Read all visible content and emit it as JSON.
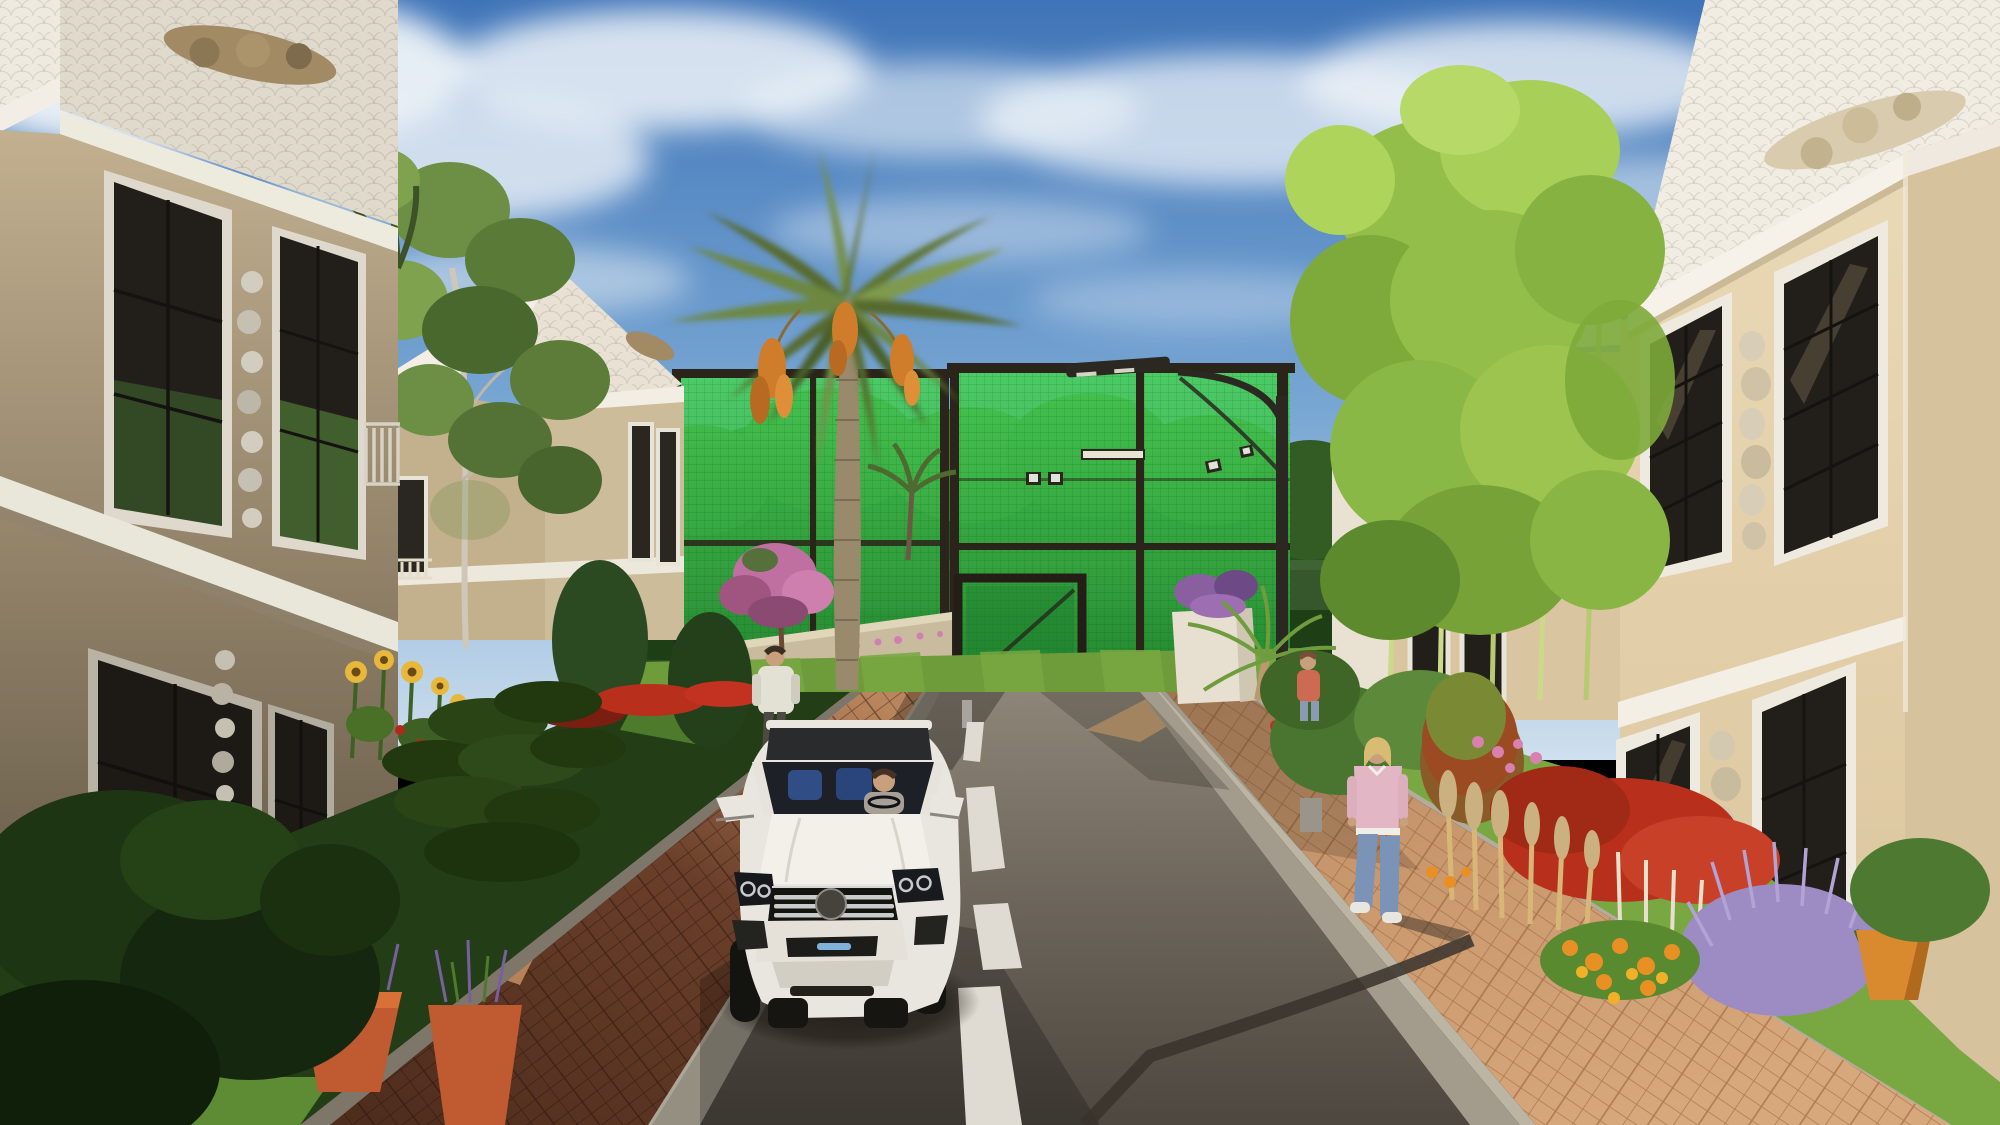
{
  "scene": {
    "title": "Residential villa street - 3D architectural rendering",
    "setting": "Sunny afternoon on a private residential street lined with two-story cream villas with white fish-scale shingle roofs and sculpted stucco crests. A white luxury SUV drives toward the viewer on an asphalt road with a dashed white center line. Brick-paver sidewalks flank the road; a green-mesh sports court with floodlights and a tall date palm close the vista.",
    "time_of_day": "late afternoon, sun from the right, long shadows on the left",
    "canvas": {
      "width": 2000,
      "height": 1125
    }
  },
  "colors": {
    "sky_top": "#3f74b8",
    "sky_horizon": "#cfe0ee",
    "cloud": "#eef3f8",
    "treeline": "#2a4f20",
    "treeline_light": "#3f6b2c",
    "mesh_green": "#3cc64d",
    "mesh_green_deep": "#1e7a2c",
    "frame_dark": "#2b241a",
    "lawn": "#6f9c3a",
    "lawn_bright": "#79a742",
    "lawn_dark": "#233e17",
    "lawn_patch": "#5d8c34",
    "wall_cream_lit": "#ead9b6",
    "wall_cream": "#d9c5a0",
    "wall_cream_shade": "#c3b18e",
    "roof_white": "#f2ede3",
    "roof_white_shade": "#e0dacd",
    "cornice_white": "#f4f0e8",
    "crest_tan": "#a18a64",
    "crest_light": "#d9cbae",
    "window_glass": "#221f1a",
    "window_frame": "#e8e4d8",
    "window_mullion": "#141310",
    "glass_green_reflection": "#4e8a38",
    "ornament_gray": "#cfc9ba",
    "road_far": "#8d8577",
    "road_near": "#4d473f",
    "road_marking": "#dfdbd2",
    "curb": "#958f82",
    "curb_light": "#ada696",
    "brick_left": "#6e4a33",
    "brick_left_lit": "#c08b5e",
    "brick_right": "#cb9a6f",
    "crossing_tan": "#c7a176",
    "lamp_dark": "#2b2822",
    "palm_frond": "#5f7434",
    "palm_frond_light": "#7d9447",
    "palm_trunk": "#9a8a6c",
    "dates_orange": "#cf7d2a",
    "bamboo": "#94be4a",
    "bamboo_light": "#aed45c",
    "bamboo_stalk": "#cdd98a",
    "birch_leaf": "#6d8f45",
    "pine_dark": "#22380f",
    "bush_dark": "#1d3512",
    "pink_tree": "#c070a0",
    "flower_red": "#b8301c",
    "flower_orange": "#e89024",
    "flower_yellow": "#e8b83a",
    "flower_pink": "#d880ae",
    "lavender": "#9d8cc4",
    "plume_tan": "#d8b678",
    "pot_orange": "#c05a30",
    "planter_white": "#e7e0d0",
    "wall_low": "#c9bc9e",
    "car_body": "#e9e6df",
    "car_glass": "#1d2026",
    "car_interior_blue": "#31508a",
    "chrome": "#c9cbcd",
    "car_dark": "#17181c",
    "skin": "#c9a07e",
    "man_shirt": "#e3e0d4",
    "man_pants": "#4d4a42",
    "woman_top": "#e3b6c6",
    "woman_jeans": "#7b93b6",
    "woman_hair": "#d8bc72",
    "shadow": "#2a251f"
  },
  "objects": {
    "sky": {
      "description": "blue sky with wispy white clouds"
    },
    "palm_tree": {
      "type": "date palm",
      "fruit": "three orange date clusters",
      "position": "center, in front of sports court"
    },
    "sports_court": {
      "type": "net-enclosed court",
      "mesh": "bright green windscreen mesh",
      "frame": "dark bronze steel posts",
      "sections": 2,
      "gate": "closed mesh gate at lower left",
      "floodlights": 4
    },
    "street_lamp": {
      "style": "dark pole with curved arm and linear head",
      "casts_shadow_on": "road, bottom right"
    },
    "houses": [
      {
        "id": "left-near-villa",
        "position": "left foreground, shaded",
        "floors": 2,
        "roof": "white fish-scale shingle gable with sculpted crest",
        "walls": "cream stucco in shadow",
        "windows": "tall black-mullion windows, white trim, carved scroll reliefs between"
      },
      {
        "id": "left-far-villa",
        "position": "left middle distance",
        "floors": 2,
        "roof": "white fish-scale gable with small crest",
        "walls": "cream stucco",
        "extras": "birch tree in front yard, small balcony"
      },
      {
        "id": "right-middle-villa",
        "position": "right middle distance behind bamboo",
        "floors": 2,
        "roof": "white gable",
        "walls": "cream stucco"
      },
      {
        "id": "right-near-villa",
        "position": "right foreground, sunlit",
        "floors": 2,
        "roof": "white fish-scale mansard with sculpted floral crest",
        "walls": "sunlit cream stucco",
        "windows": "tall black-mullion windows, white trim, carved scroll reliefs between"
      }
    ],
    "vehicle": {
      "type": "white luxury SUV",
      "direction": "driving toward viewer",
      "driver": "woman at right-hand steering wheel",
      "grille": "three chrome bars with dark round badge",
      "details": [
        "chrome-ringed headlights",
        "blue accent bar in lower bumper",
        "white side mirrors",
        "dark panoramic roof"
      ]
    },
    "pedestrians": [
      {
        "id": "man-left-sidewalk",
        "clothing": "white long-sleeve shirt, dark trousers",
        "action": "walking away on shaded left sidewalk"
      },
      {
        "id": "woman-right-sidewalk",
        "clothing": "pink sweater, blue jeans, white sneakers",
        "hair": "blonde",
        "action": "walking toward viewer on sunlit right sidewalk"
      },
      {
        "id": "person-near-court",
        "clothing": "coral top, blue jeans",
        "action": "standing near court entrance"
      }
    ],
    "road": {
      "surface": "asphalt",
      "marking": "white dashed center line",
      "dashes_visible": 4,
      "shadows": [
        "street lamp",
        "car",
        "trees"
      ],
      "end": "tan paver crossing at court entrance with small white marker post"
    },
    "sidewalks": [
      {
        "side": "left",
        "paving": "red-brown brick pavers, mostly in shadow with one sunlit patch",
        "curb": "gray concrete"
      },
      {
        "side": "right",
        "paving": "tan-pink brick pavers, sunlit",
        "curb": "gray concrete"
      }
    ],
    "vegetation": [
      "bamboo grove on right",
      "birch tree",
      "layered topiary pine",
      "dark conifers",
      "pink flowering tree",
      "sunflowers",
      "red salvia hedge",
      "lavender mound",
      "orange and yellow flower bed",
      "tan plume grasses",
      "terracotta pots with purple salvia",
      "white planter with purple flowers and small palm",
      "dense dark bushes bottom left"
    ]
  }
}
